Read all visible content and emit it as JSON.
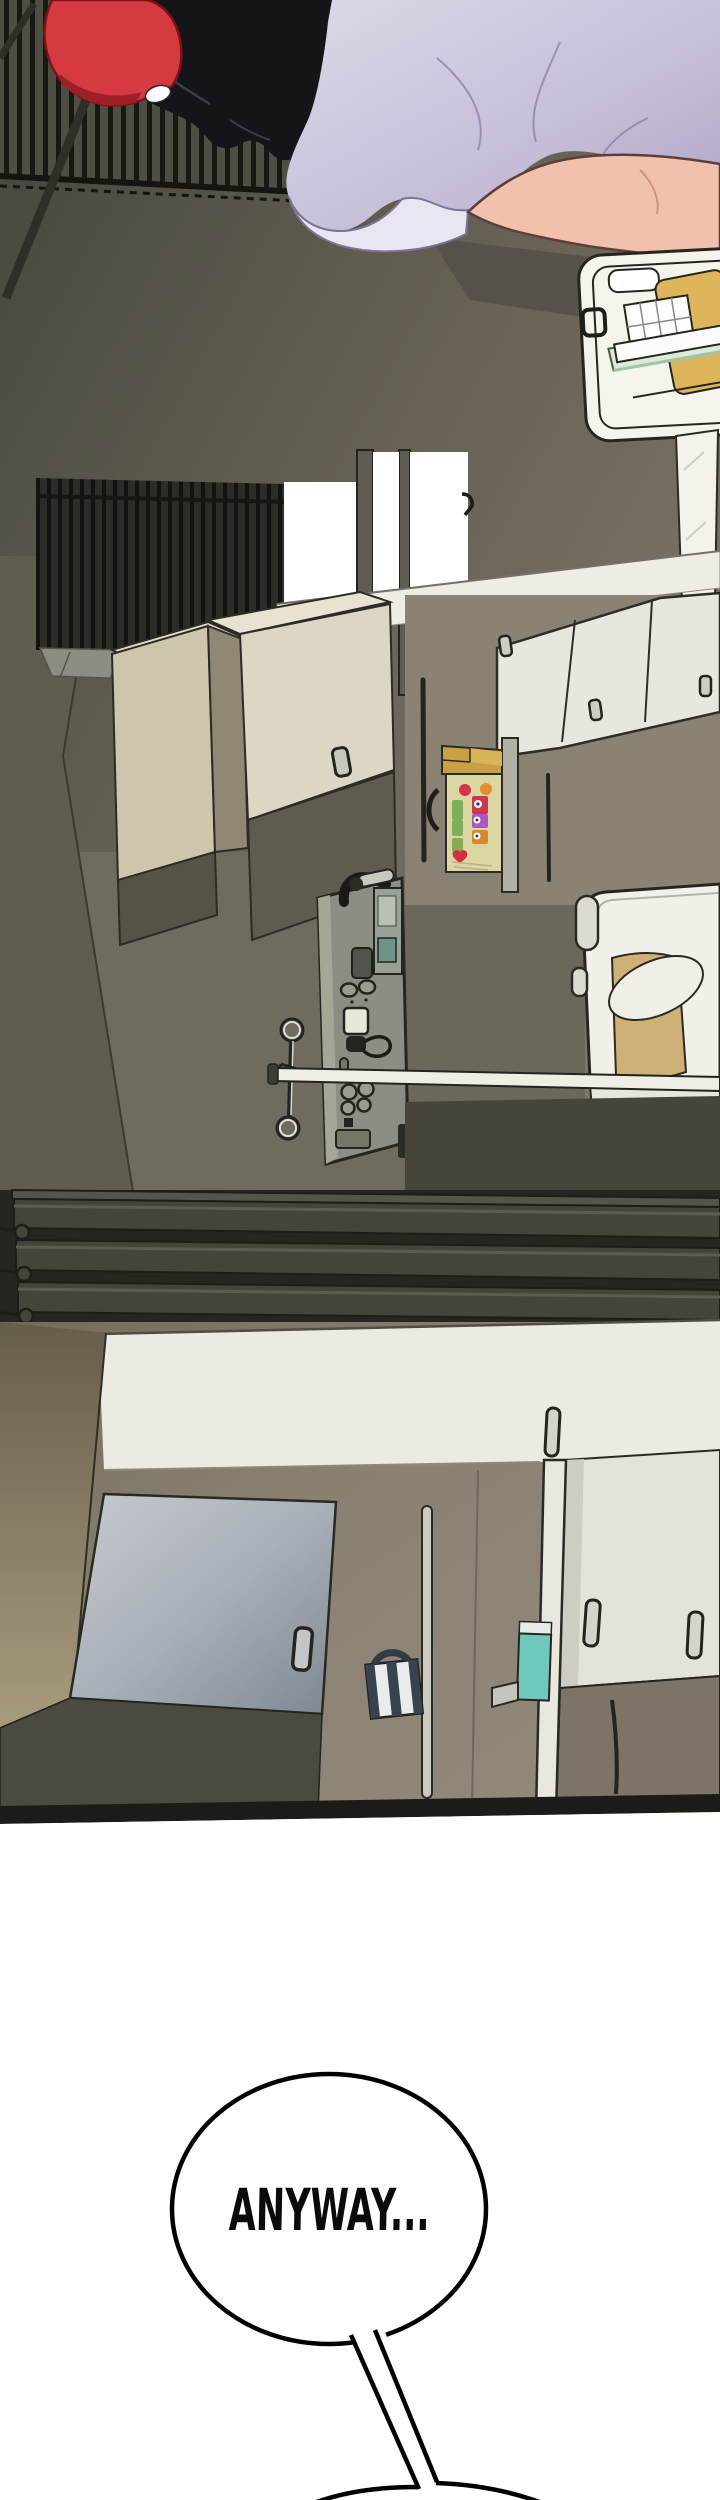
{
  "page": {
    "width": 720,
    "height": 2500,
    "background": "#ffffff",
    "type": "webtoon-episode-segment"
  },
  "speech_bubble": {
    "text": "ANYWAY...",
    "fill": "#ffffff",
    "outline": "#000000"
  },
  "panels": [
    {
      "id": "panel-1",
      "description": "Rotated (sideways) kitchen interior: woman with black wavy hair, red cap and lavender shirt at top; white dish-drying rack with yellow cutting board; window with dark security grate; beige base cabinets and white cupboards; open condiment shelf with colorful bottles; grey sink fixture with faucet; hanging rail and white towel bar; white chair with tan cushion; dark slatted blinds at bottom edge"
    },
    {
      "id": "panel-2",
      "description": "Rotated kitchen counter close-up: white counter band, blue-grey cabinet door with handle, hanging navy-striped mug, teal dispenser on white pillar, white cabinet doors with metal handles, dark baseboard edge"
    }
  ],
  "objects": [
    "security-grate",
    "woman",
    "red-cap",
    "black-hair",
    "lavender-shirt",
    "bare-arm",
    "dish-rack",
    "cutting-board",
    "wire-basket",
    "drying-trays",
    "window-panes",
    "window-latch-hooks",
    "upper-cupboards",
    "base-cabinets",
    "condiment-shelf",
    "condiment-bottles",
    "sink-unit",
    "faucet",
    "soap-dispenser",
    "hanging-rail",
    "towel-bar",
    "white-chair",
    "blind-slats",
    "cabinet-door",
    "striped-mug",
    "teal-dispenser",
    "cabinet-handles",
    "speech-bubble",
    "second-bubble-edge"
  ],
  "palette": {
    "wall_olive": "#676255",
    "wall_tan": "#8a8273",
    "floor": "#6f6b5e",
    "grate_dark": "#1a1a17",
    "blinds": "#45443b",
    "cabinet_beige": "#cdc6ad",
    "cabinet_white": "#e9e7dd",
    "counter_white": "#edebe1",
    "cap_red": "#d63a41",
    "hair_black": "#141419",
    "shirt_lavender": "#c6bdd8",
    "skin": "#f2c1ae",
    "board_yellow": "#dfb55c",
    "shelf_yellow": "#dcd7a2",
    "teal": "#6ec9bd",
    "door_bluegray": "#aab0b8",
    "mug_navy": "#39424f",
    "bubble_outline": "#000000"
  }
}
